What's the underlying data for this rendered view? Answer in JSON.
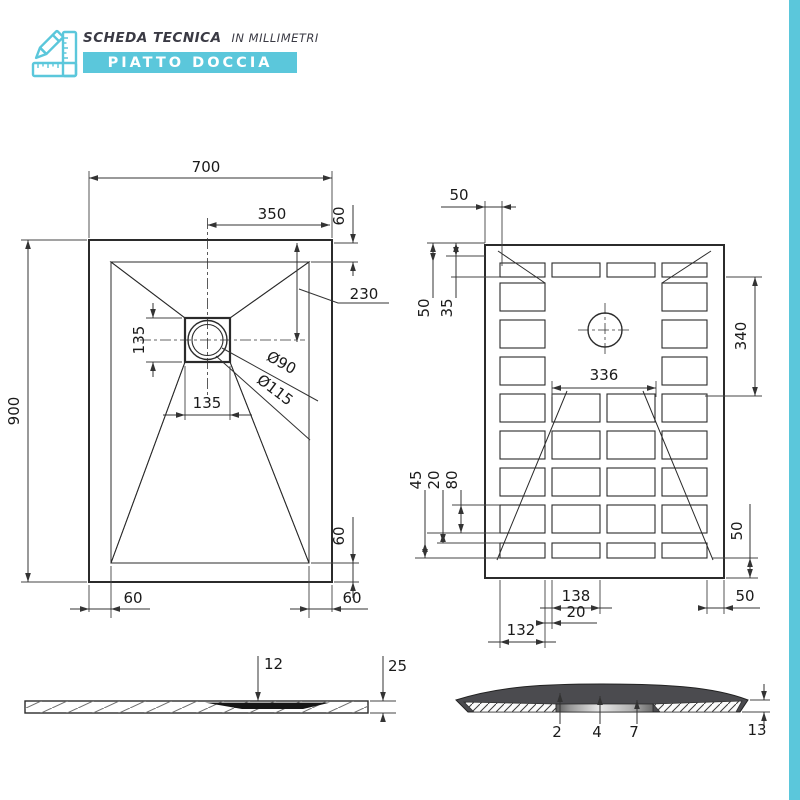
{
  "header": {
    "title": "SCHEDA TECNICA",
    "subtitle": "IN MILLIMETRI",
    "band_label": "PIATTO DOCCIA",
    "accent_color": "#5BC7DB"
  },
  "top_view": {
    "width": "700",
    "height": "900",
    "drain_offset_x": "350",
    "rim_top": "60",
    "drain_offset_y": "230",
    "drain_box_w": "135",
    "drain_box_h": "135",
    "drain_dia_inner": "Ø90",
    "drain_dia_outer": "Ø115",
    "rim_bottom_left": "60",
    "rim_bottom_right": "60",
    "rim_side": "60"
  },
  "bottom_view": {
    "edge_margin_top": "50",
    "offset_a": "50",
    "offset_b": "35",
    "side_span": "340",
    "center_span": "336",
    "slot_a": "45",
    "gap": "20",
    "pitch": "80",
    "side_margin": "50",
    "slot_width": "138",
    "rib": "20",
    "first_slot": "132",
    "corner_margin": "50"
  },
  "profile_view": {
    "recess_depth": "12",
    "thickness": "25"
  },
  "section_view": {
    "lip": "2",
    "base": "4",
    "plug": "7",
    "edge_thickness": "13"
  }
}
